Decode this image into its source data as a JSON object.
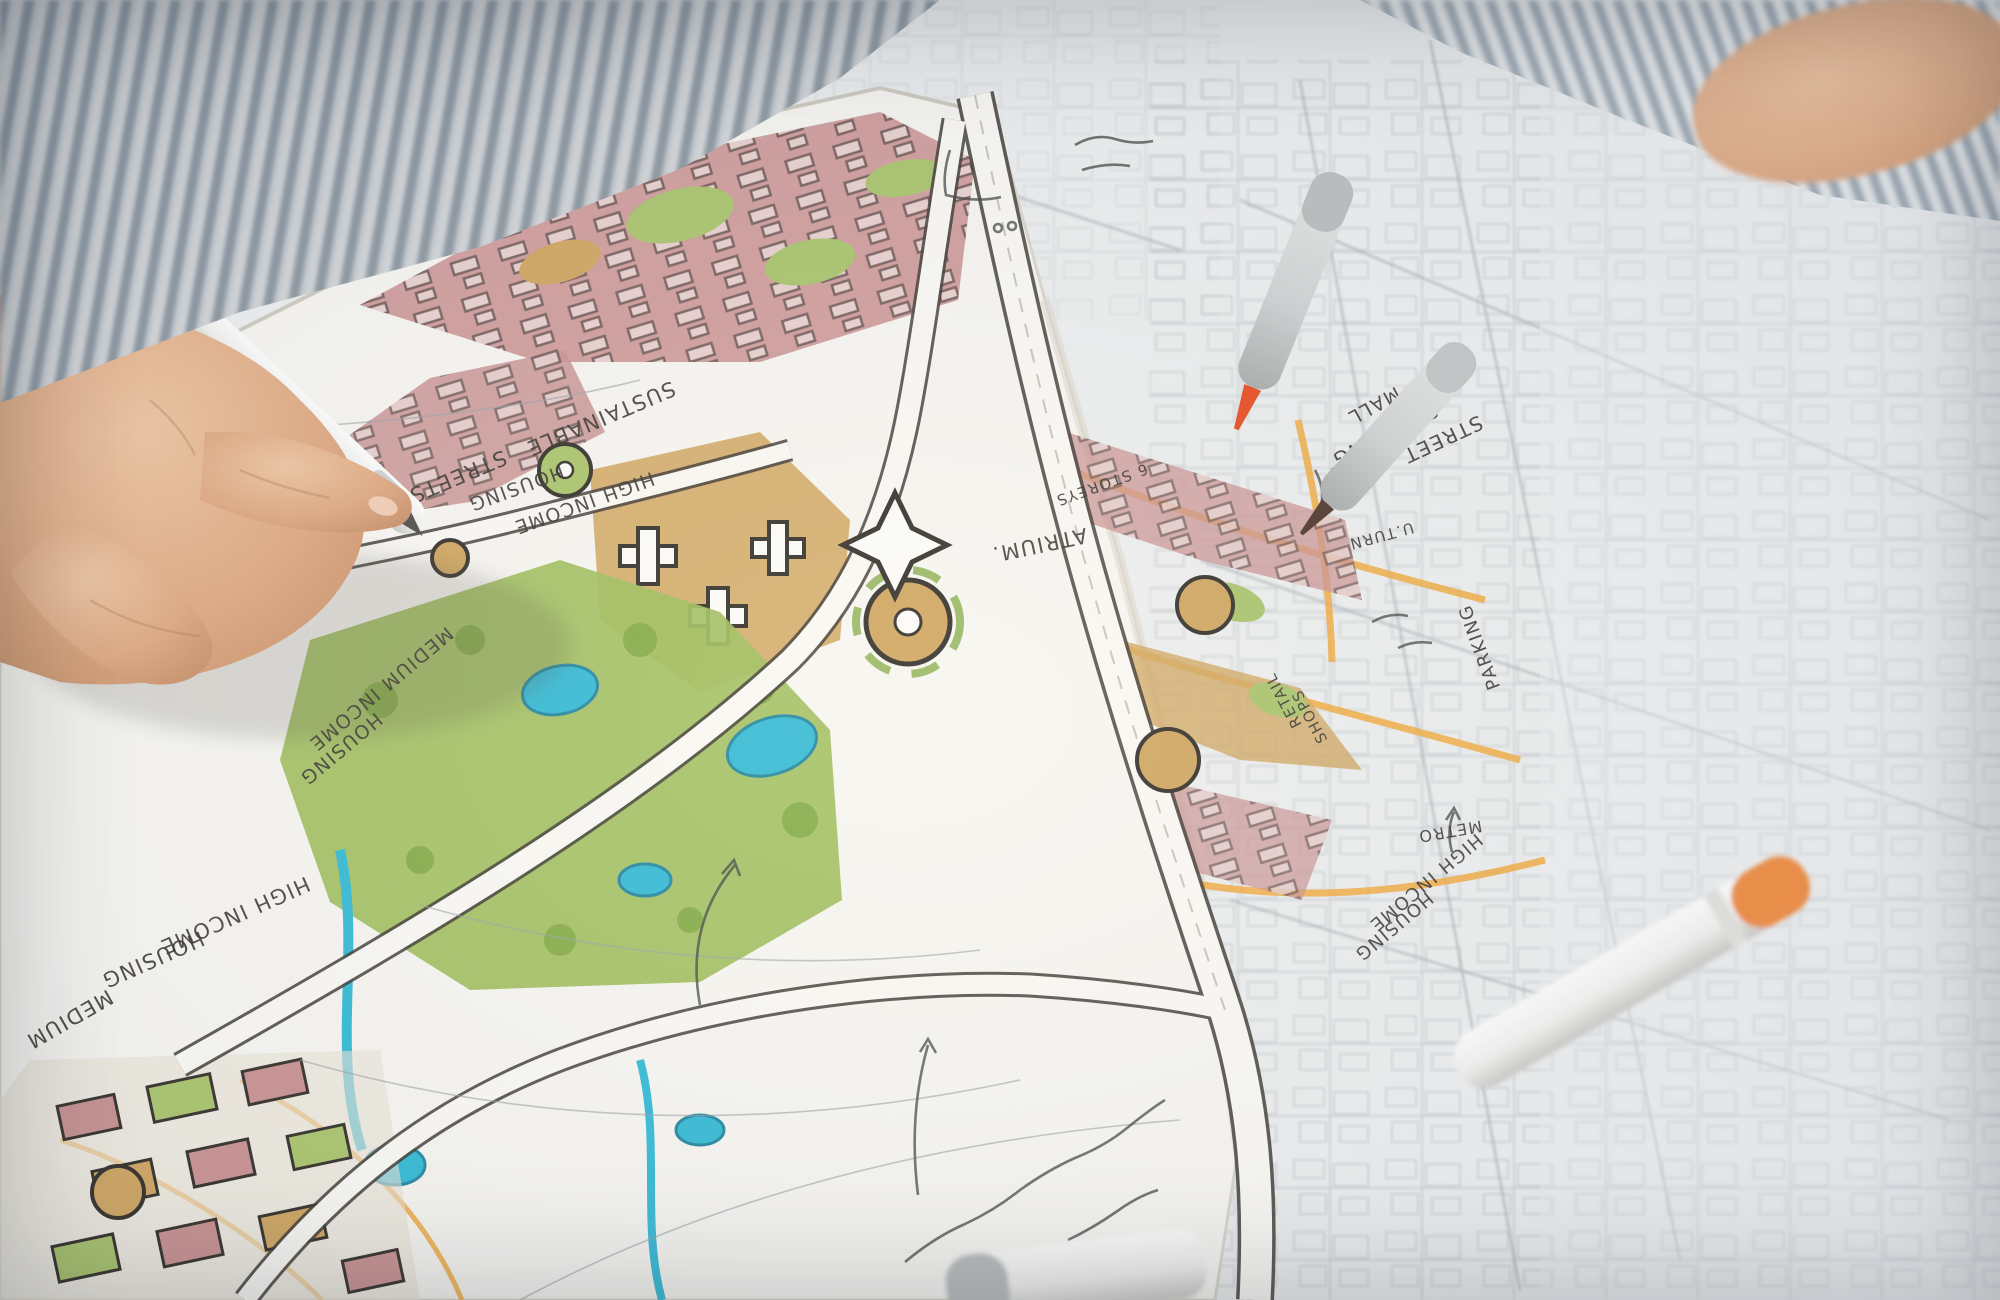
{
  "scene": {
    "description": "Photograph of an urban planner's hand drawing with a marker on a hand-colored master plan sketch over a printed city base map; spare marker pens lie on the map",
    "subject": "urban master plan sketch",
    "person": "hand in striped shirt holding marker"
  },
  "palette": {
    "ink": "#33302b",
    "residential-pink": "#c99090",
    "park-olive": "#9cbd59",
    "courtyard-green": "#a8c46a",
    "plaza-tan": "#d0a55e",
    "water-teal": "#2fb9d6",
    "road-orange": "#f2a93b",
    "sketch-paper": "#f7f6f2",
    "base-map": "#edeff0",
    "skin": "#e4b08c",
    "shirt-stripe": "#97a3ad",
    "marker-green-cap": "#76b82a",
    "marker-orange-cap": "#f08a3c",
    "marker-red-nib": "#e8481c"
  },
  "markers": [
    {
      "name": "held marker",
      "body": "white",
      "cap": "green"
    },
    {
      "name": "gray marker with red-orange nib",
      "body": "light gray",
      "nib": "red-orange"
    },
    {
      "name": "gray marker with brown nib",
      "body": "gray",
      "nib": "dark brown"
    },
    {
      "name": "white marker with orange cap",
      "body": "white",
      "cap": "orange"
    },
    {
      "name": "white marker with gray band",
      "body": "white",
      "cap": "gray"
    }
  ],
  "annotations": [
    {
      "text": "SUSTAINABLE",
      "x": 598,
      "y": 412,
      "rot": 157,
      "size": 21
    },
    {
      "text": "STREETS",
      "x": 455,
      "y": 470,
      "rot": 157,
      "size": 21
    },
    {
      "text": "HIGH INCOME",
      "x": 582,
      "y": 497,
      "rot": 160,
      "size": 19
    },
    {
      "text": "HOUSING",
      "x": 514,
      "y": 482,
      "rot": 160,
      "size": 19
    },
    {
      "text": "MEDIUM INCOME",
      "x": 377,
      "y": 684,
      "rot": 140,
      "size": 19
    },
    {
      "text": "HOUSING",
      "x": 337,
      "y": 744,
      "rot": 140,
      "size": 19
    },
    {
      "text": "HIGH INCOME",
      "x": 232,
      "y": 909,
      "rot": 156,
      "size": 21
    },
    {
      "text": "HOUSING",
      "x": 150,
      "y": 953,
      "rot": 156,
      "size": 21
    },
    {
      "text": "MEDIUM",
      "x": 66,
      "y": 1013,
      "rot": 150,
      "size": 21
    },
    {
      "text": "STREET",
      "x": 1440,
      "y": 433,
      "rot": 155,
      "size": 20
    },
    {
      "text": "SHOPPING",
      "x": 1382,
      "y": 429,
      "rot": 153,
      "size": 20
    },
    {
      "text": "MALL",
      "x": 1371,
      "y": 400,
      "rot": 151,
      "size": 19
    },
    {
      "text": "ATRIUM.",
      "x": 1038,
      "y": 538,
      "rot": 168,
      "size": 21
    },
    {
      "text": "6 STOREYS",
      "x": 1100,
      "y": 480,
      "rot": 160,
      "size": 15
    },
    {
      "text": "U.TURN",
      "x": 1380,
      "y": 531,
      "rot": 165,
      "size": 15
    },
    {
      "text": "PARKING",
      "x": 1485,
      "y": 645,
      "rot": 250,
      "size": 18
    },
    {
      "text": "RETAIL",
      "x": 1288,
      "y": 698,
      "rot": 242,
      "size": 15
    },
    {
      "text": "SHOPS",
      "x": 1314,
      "y": 714,
      "rot": 242,
      "size": 15
    },
    {
      "text": "METRO",
      "x": 1449,
      "y": 826,
      "rot": 170,
      "size": 16
    },
    {
      "text": "HIGH INCOME",
      "x": 1422,
      "y": 878,
      "rot": 140,
      "size": 18
    },
    {
      "text": "HOUSING",
      "x": 1390,
      "y": 922,
      "rot": 140,
      "size": 18
    }
  ]
}
